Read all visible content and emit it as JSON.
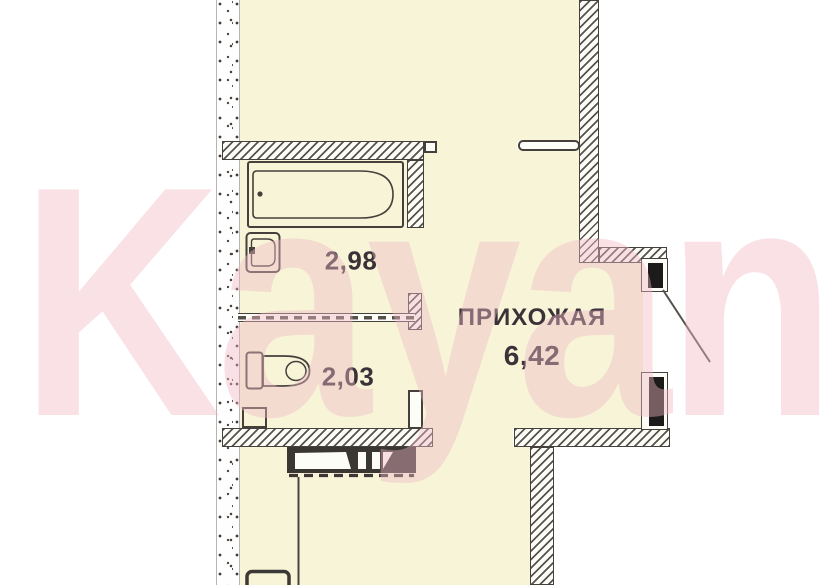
{
  "watermark": {
    "text": "Kayan"
  },
  "rooms": {
    "hallway": {
      "name": "ПРИХОЖАЯ",
      "area": "6,42"
    },
    "bathroom": {
      "area": "2,98"
    },
    "wc": {
      "area": "2,03"
    }
  },
  "fixtures": [
    "bathtub",
    "sink",
    "toilet",
    "built-in-cabinet",
    "entrance-door"
  ],
  "colors": {
    "room_fill": "#F7F4D8",
    "wall_line": "#45403C",
    "watermark_pink": "#F2B9C6",
    "label_text": "#3A3238",
    "door_jamb": "#1D1B1A"
  }
}
